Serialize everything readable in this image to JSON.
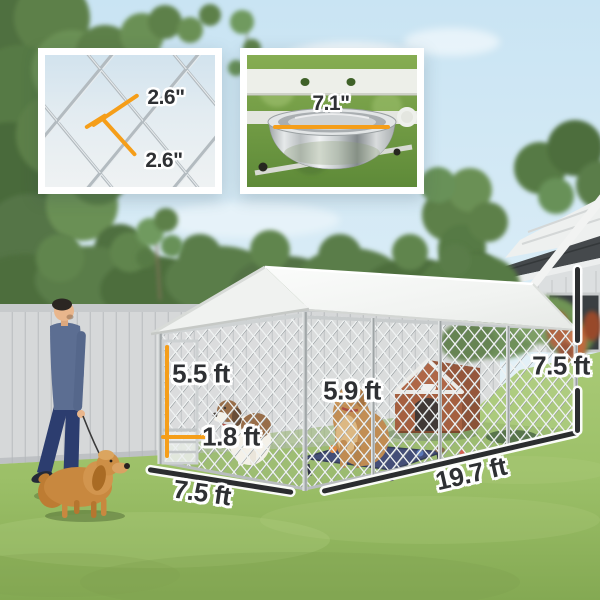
{
  "insets": {
    "mesh_detail": {
      "measure_a": "2.6\"",
      "measure_b": "2.6\""
    },
    "bowl_detail": {
      "diameter": "7.1\""
    }
  },
  "kennel_dimensions": {
    "door_height": "5.5 ft",
    "door_width": "1.8 ft",
    "interior_height": "5.9 ft",
    "front_width": "7.5 ft",
    "side_length": "19.7 ft",
    "overall_height": "7.5 ft"
  },
  "colors": {
    "accent_orange": "#F59E19",
    "measure_line_dark": "#2B2D2F",
    "label_text": "#2E3033",
    "canopy_white": "#F4F6F4",
    "sky_blue": "#CDE7F4",
    "grass_green": "#9CC068",
    "fence_gray": "#D6D8D9",
    "dog_house_brown": "#9B4F2B",
    "pet_cot_navy": "#2F3A68"
  }
}
